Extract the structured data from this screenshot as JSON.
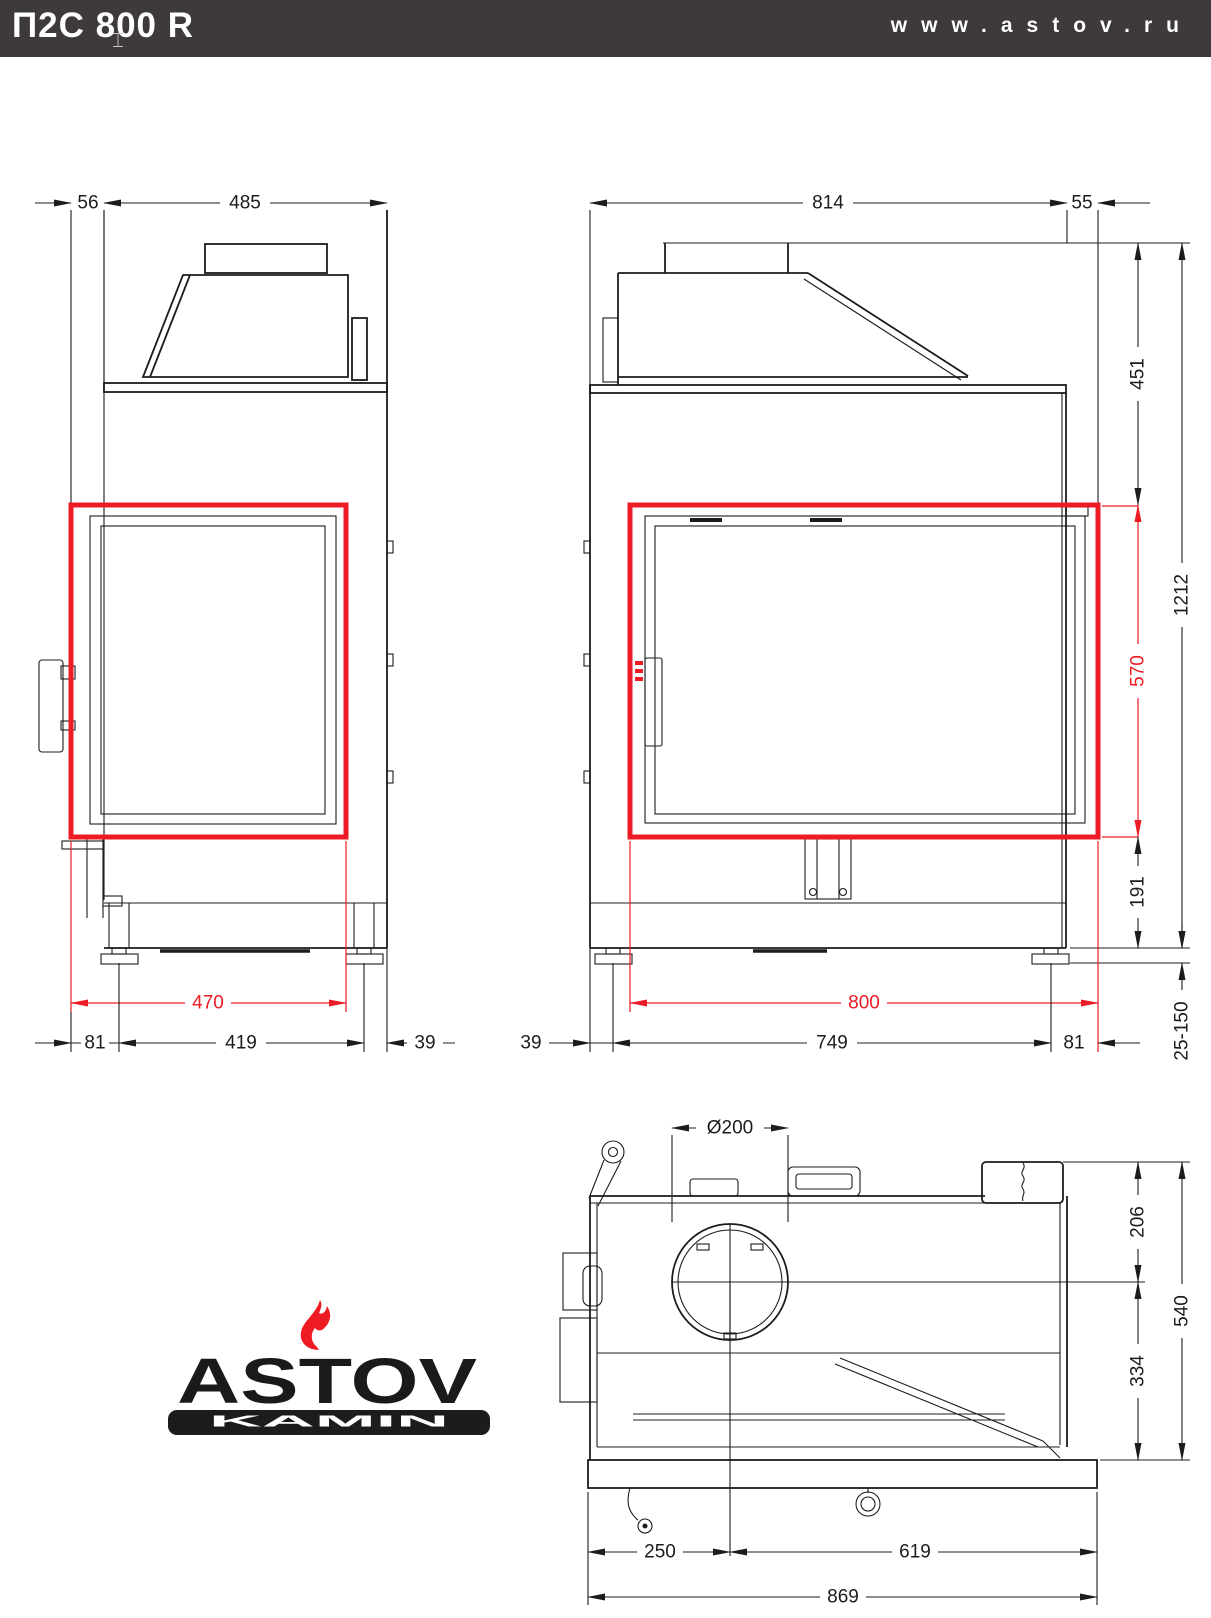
{
  "header": {
    "title": "П2С 800 R",
    "website": "www.astov.ru"
  },
  "colors": {
    "highlight_red": "#ed1c24",
    "line_black": "#1c1c1c",
    "header_bg": "#3e3a39"
  },
  "logo": {
    "brand": "ASTOV",
    "tagline": "KAMIN"
  },
  "views": {
    "side": {
      "dims": {
        "front_offset": "56",
        "body_depth": "485",
        "glass_depth_red": "470",
        "bottom_front": "81",
        "leg_span": "419",
        "bottom_back": "39"
      }
    },
    "front": {
      "dims": {
        "body_width": "814",
        "side_offset": "55",
        "hood_height": "451",
        "glass_height_red": "570",
        "base_height": "191",
        "total_height": "1212",
        "leg_adjust_range": "25-150",
        "glass_width_red": "800",
        "bottom_left": "39",
        "leg_span": "749",
        "bottom_right": "81"
      }
    },
    "top": {
      "dims": {
        "flue_diameter": "Ø200",
        "flue_to_back": "206",
        "flue_to_front": "334",
        "total_depth": "540",
        "flue_from_left": "250",
        "flue_to_right": "619",
        "total_width": "869"
      }
    }
  }
}
